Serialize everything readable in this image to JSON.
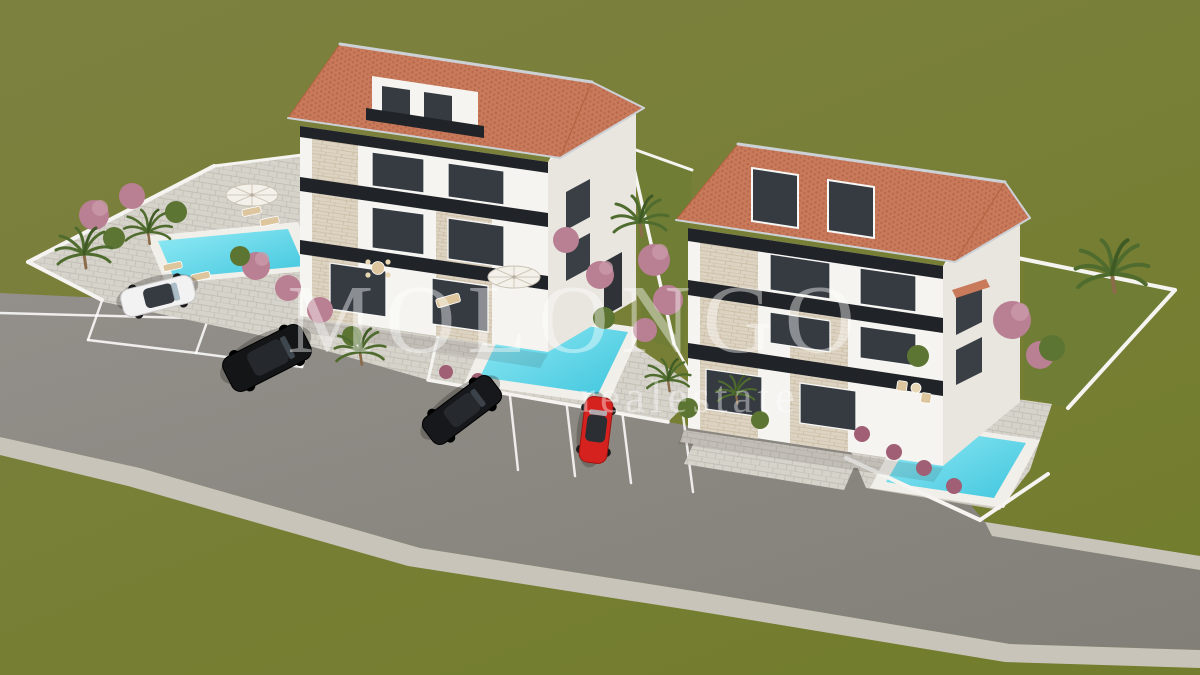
{
  "watermark": {
    "brand": "MOLONGO",
    "tagline": "realestate"
  },
  "colors": {
    "grass": "#7d8140",
    "grass_dark": "#737d2e",
    "lawn": "#6f7d35",
    "asphalt": "#938f8a",
    "asphalt_dark": "#827f78",
    "sidewalk": "#c8c4ba",
    "pavement": "#d6d3cb",
    "paver_line": "#c3bfb6",
    "stone": "#ddd3c2",
    "stone_line": "#cabba1",
    "wall_white": "#f5f4f0",
    "wall_shade": "#e9e6e0",
    "gable": "#f6f4f0",
    "roof": "#c87a5b",
    "roof_dot": "#a9583e",
    "trim": "#ccd1d6",
    "glass": "#363b42",
    "band": "#202327",
    "coping": "#f1efe9",
    "pool": "#41c6de",
    "pool_light": "#93ebf5",
    "car_white": "#f2f2f2",
    "car_black": "#141517",
    "car_red": "#d6221e",
    "palm": "#4f6c2e",
    "palm_dark": "#3f5a24",
    "bush_pink": "#b97f92",
    "bush_pink_light": "#c99aa9",
    "bush_green": "#5d7533",
    "furniture_tan": "#ddc69e",
    "shadow": "#2e2c28"
  },
  "scene": {
    "kind": "aerial 3d architectural rendering",
    "houses": [
      {
        "name": "left-villa",
        "storeys": 3,
        "roof": "terracotta hip",
        "facade": "white with stone bands and dark balcony railings",
        "pools": 2
      },
      {
        "name": "right-villa",
        "storeys": 3,
        "roof": "terracotta hip with attic dormer windows",
        "facade": "white with stone bands and dark balcony railings",
        "pools": 1
      }
    ],
    "pools": [
      {
        "name": "left-plot-pool"
      },
      {
        "name": "middle-terrace-pool"
      },
      {
        "name": "right-corner-pool"
      }
    ],
    "cars": [
      {
        "name": "white-coupe",
        "color": "white"
      },
      {
        "name": "black-suv",
        "color": "black"
      },
      {
        "name": "black-sedan",
        "color": "black"
      },
      {
        "name": "red-coupe",
        "color": "red"
      }
    ],
    "road": {
      "surface": "asphalt",
      "features": [
        "parking bays with white stripes",
        "light sidewalk bands"
      ]
    },
    "vegetation": [
      "palm trees",
      "pink flowering shrubs",
      "green bushes",
      "olive-green lawn"
    ]
  }
}
